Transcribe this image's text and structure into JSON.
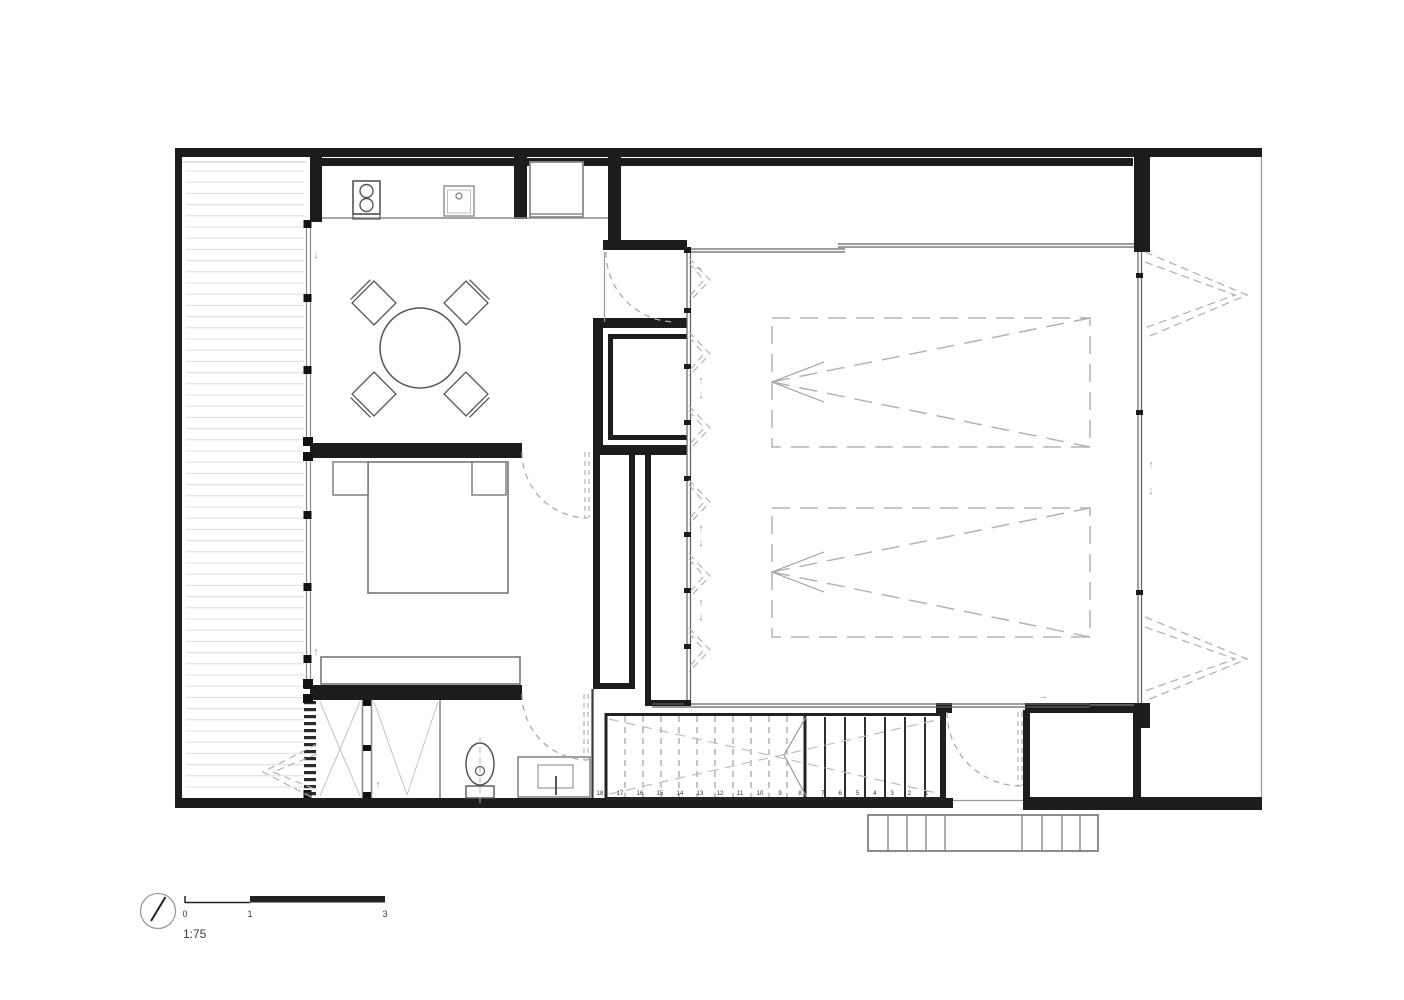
{
  "plan": {
    "drawing_type": "floor-plan",
    "scale_bar": {
      "ratio": "1:75",
      "tick_labels": [
        "0",
        "1",
        "3"
      ]
    },
    "stairs": {
      "tread_numbers": [
        "1",
        "2",
        "3",
        "4",
        "5",
        "6",
        "7",
        "8",
        "9",
        "10",
        "11",
        "12",
        "13",
        "14",
        "15",
        "16",
        "17",
        "18"
      ]
    },
    "glyphs": {
      "arrow_up": "↑",
      "arrow_down": "↓",
      "arrow_right": "→"
    },
    "icons": {
      "north_arrow": "north-arrow-icon",
      "stove": "stove-burners-icon",
      "sink": "kitchen-sink-icon",
      "toilet": "toilet-icon",
      "vanity": "bathroom-vanity-icon",
      "dining_table": "round-dining-table-icon",
      "bed": "double-bed-icon"
    },
    "colors": {
      "wall": "#1c1c1c",
      "line_medium": "#555555",
      "furniture": "#707070",
      "light_line": "#9e9e9e",
      "dashed": "#b3b3b3",
      "deck_line": "#dedede",
      "text": "#3a3a3a",
      "background": "#ffffff"
    }
  }
}
